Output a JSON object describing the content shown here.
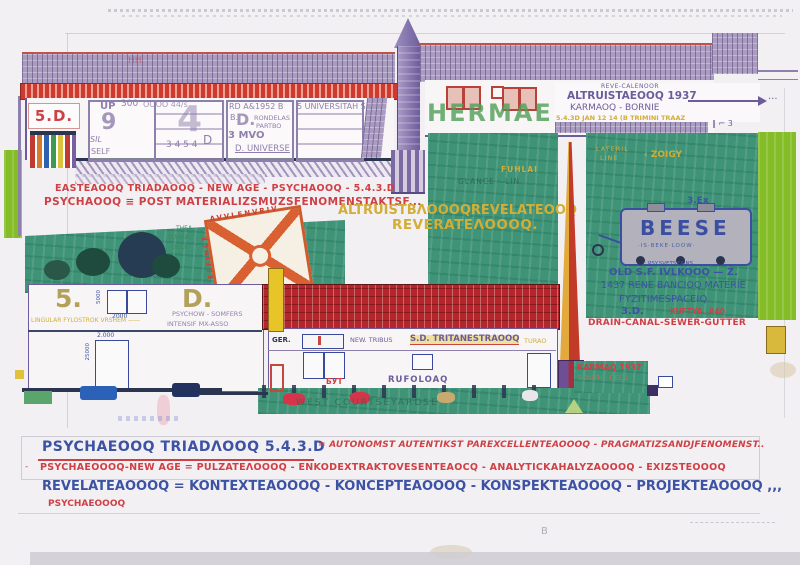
{
  "colors": {
    "paper": "#f2f0f3",
    "ink_purple": "#6b5d9b",
    "ink_red": "#cf4045",
    "ink_blue": "#3c52a4",
    "ink_yellow": "#d2ae38",
    "teal_green": "#3f9478",
    "lime_green": "#85bd28",
    "roof_red": "#b4262b",
    "orange": "#d96030"
  },
  "storefront": {
    "sign": "5.D.",
    "roof_mark": "HH",
    "up": "UP",
    "nine": "9",
    "num300": "300",
    "num_oooo": "OOOO 44/s",
    "sil": "SIL",
    "self": "SELF",
    "big4": "4",
    "num3454": "3 4 5 4",
    "d_small": "D",
    "rd1952": "RD A&1952 B",
    "b_dot": "B.",
    "d_mid": "D.",
    "rondelas": "RONDELAS",
    "partbo": "PARTBO",
    "mvo": "3 MVO",
    "universe": "D. UNIVERSE",
    "universitah": "5 UNIVERSITAH S"
  },
  "tower_building": {
    "graffiti": "HERMAEN",
    "reve": "REVE-CALENOOR",
    "altruista": "ALTRUISTAEOOQ 1937",
    "karmaoq": "KARMAOQ - BORNIE",
    "trimini": "5.4.3D JAN 12 14 (B TRIMINI TRAAZ",
    "dots": "...",
    "marks": "‖ ⌐ 3"
  },
  "mid_texts": {
    "east_line": "EASTEAOOQ TRIADAOOQ - NEW AGE - PSYCHAOOQ - 5.4.3.D",
    "psych_post": "PSYCHAOOQ ≡ POST MATERIALIZSMUZSFENOMENSTAKTSF...",
    "altruist_revelate": "ALTRUISTBΛOOOQREVELATEOOQ",
    "reverate": "REVERATEΛOOOQ."
  },
  "hedge": {
    "line1": "THEA",
    "line2": "SUNRAL",
    "line3": "BECK"
  },
  "diamond": {
    "top_letters": "AVVLENVRIV",
    "left_letters": "ESFINGE"
  },
  "field_left": {
    "fuhlai": "FUHLAI",
    "glance": "GLANCE · LIN"
  },
  "field_right": {
    "lateril": "LATERIL",
    "line": "LINE",
    "zoigy": "‹ ZOIGY",
    "label_3ex": "3.Ex",
    "beese": "BEESE",
    "beese_sub": "·IS·BEKE·LOOW·",
    "psy_svets": "PSY.SVETSZAINS.",
    "old_sf": "OLD S.F. IVLKOOQ — Z.",
    "rene": "1437 RENE BANCIOQ MATERIE",
    "fyziti": "FYZITIMESPACEIQ",
    "label_3d": "3.D.",
    "kuftya": "KUFTYA. #40",
    "drain": "DRAIN-CANAL-SEWER-GUTTER"
  },
  "karmaq_patch": {
    "karmaq": "KARMAQ 1937",
    "south": "SOUTH - ČELO"
  },
  "long_building": {
    "ger": "GER.",
    "new_tribus": "NEW. TRIBUS",
    "tritanestra": "S.D. TRITANESTRAOOQ",
    "turao": "TURAO",
    "byt": "БУТ",
    "rufoloaq": "RUFOLOAQ",
    "west_yard": "WEST COURTSEYARDSE"
  },
  "left_building": {
    "five": "5.",
    "dee": "D.",
    "dim_5000": "5000",
    "dim_2000": "2000",
    "dim_2000b": "2.000",
    "dim_25000": "25000",
    "lingular": "LINGULAR FYLOSTROK VRSHEM ——",
    "psychow": "PSYCHOW - SOMFERS",
    "intensif": "INTENSIF MX-ASSO"
  },
  "bottom": {
    "line1_blue": "PSYCHAEOOQ TRIADΛOOQ 5.4.3.D",
    "line1_red": "= AUTONOMST AUTENTIKST PAREXCELLENTEAOOOQ - PRAGMATIZSANDJFENOMENST..",
    "line2_dash": "-",
    "line2_red": "PSYCHAEOOOQ-NEW AGE = PULZATEΛOOOQ - ENKODEXTRAKTOVESENTEAOCQ - ANALYTICKAHALYZAOOOQ - EXIZSTEOOOQ",
    "line3_blue": "REVELATEAOOOQ = KONTEXTEAOOOQ - KONCEPTEAOOOQ - KONSPEKTEAOOOQ - PROJEKTEAOOOQ ,,,",
    "line3_red": "PSYCHAEOOOQ",
    "stray": "B"
  }
}
